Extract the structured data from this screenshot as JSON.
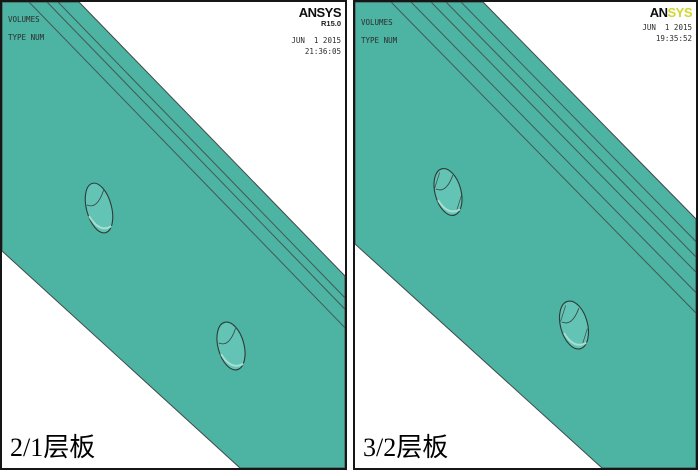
{
  "figure": {
    "description": "ANSYS volume plots of laminated plates with two holes"
  },
  "colors": {
    "plate": "#4db3a3",
    "hole": "#63c3b4",
    "shine": "#a5ded2",
    "edge": "#3f4a47",
    "logo_yellow": "#d2d62e",
    "background": "#ffffff",
    "border": "#161616"
  },
  "panels": [
    {
      "id": "left",
      "annotations": {
        "line1": "VOLUMES",
        "line2": "TYPE NUM"
      },
      "logo": {
        "black": "ANSYS",
        "yellow": "",
        "version": "R15.0"
      },
      "datetime": {
        "date": "JUN  1 2015",
        "time": "21:36:05"
      },
      "caption": "2/1层板",
      "layer_lines": 3,
      "holes": 2
    },
    {
      "id": "right",
      "annotations": {
        "line1": "VOLUMES",
        "line2": "TYPE NUM"
      },
      "logo": {
        "black": "AN",
        "yellow": "SYS",
        "version": ""
      },
      "datetime": {
        "date": "JUN  1 2015",
        "time": "19:35:52"
      },
      "caption": "3/2层板",
      "layer_lines": 5,
      "holes": 2
    }
  ]
}
